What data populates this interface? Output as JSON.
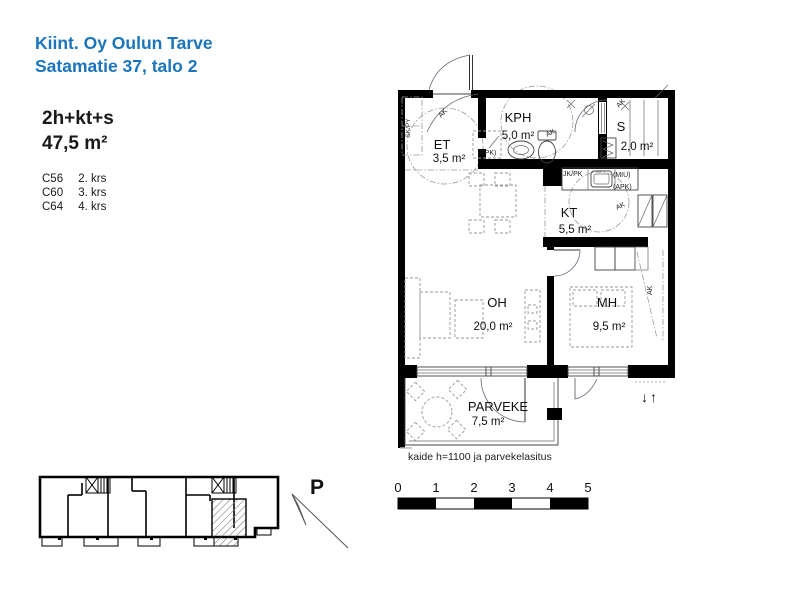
{
  "header": {
    "company": "Kiint. Oy Oulun Tarve",
    "address": "Satamatie 37, talo 2"
  },
  "apartment": {
    "type": "2h+kt+s",
    "area": "47,5 m²",
    "units": [
      {
        "id": "C56",
        "floor": "2. krs"
      },
      {
        "id": "C60",
        "floor": "3. krs"
      },
      {
        "id": "C64",
        "floor": "4. krs"
      }
    ]
  },
  "floor_plan": {
    "rooms": [
      {
        "name": "ET",
        "area": "3,5 m²"
      },
      {
        "name": "KPH",
        "area": "5,0 m²"
      },
      {
        "name": "S",
        "area": "2,0 m²"
      },
      {
        "name": "KT",
        "area": "5,5 m²"
      },
      {
        "name": "OH",
        "area": "20,0 m²"
      },
      {
        "name": "MH",
        "area": "9,5 m²"
      },
      {
        "name": "PARVEKE",
        "area": "7,5 m²"
      }
    ],
    "labels": {
      "skpy": "SK/PY",
      "ppk": "(PPK)",
      "jkpk": "JK/PK",
      "miu": "(MIU)",
      "apk": "(APK)",
      "ak": "AK",
      "updown": "↓↑"
    },
    "note": "kaide h=1100 ja parvekelasitus"
  },
  "north_arrow": {
    "label": "P"
  },
  "scale_bar": {
    "ticks": [
      "0",
      "1",
      "2",
      "3",
      "4",
      "5"
    ]
  },
  "colors": {
    "accent": "#1b75bc",
    "wall": "#000000"
  }
}
